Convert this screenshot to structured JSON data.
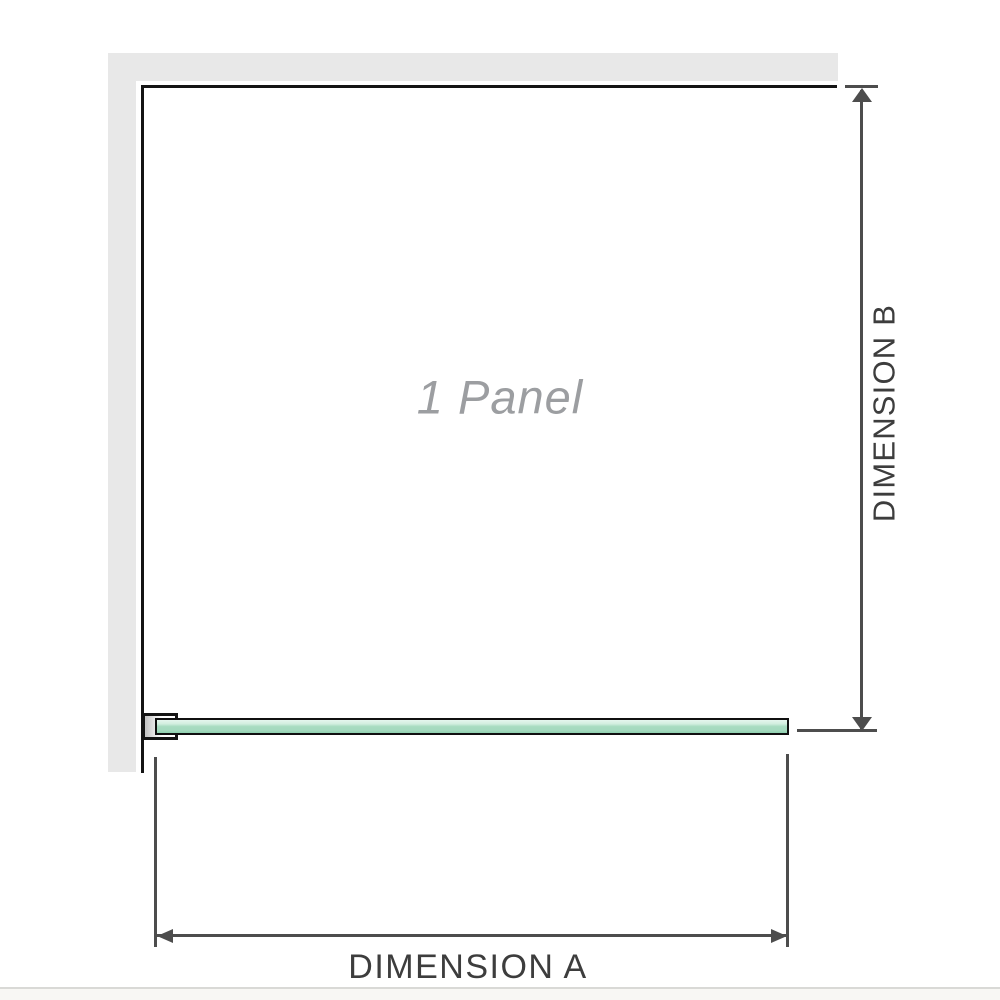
{
  "diagram": {
    "panel_label": "1 Panel",
    "dimension_a_label": "DIMENSION A",
    "dimension_b_label": "DIMENSION B"
  },
  "colors": {
    "wall_fill": "#e8e8e8",
    "panel_outline": "#141414",
    "dimension_line": "#4d4d4d",
    "dimension_text": "#3d3d3d",
    "panel_label_text": "#9c9ea1",
    "glass_green_light": "#e6f6ee",
    "glass_green_mid": "#a6dabf",
    "glass_green_dark": "#8fd0ae",
    "glass_border": "#101010",
    "footer_divider": "#d9d9d6",
    "footer_strip": "#f8f7f4"
  }
}
